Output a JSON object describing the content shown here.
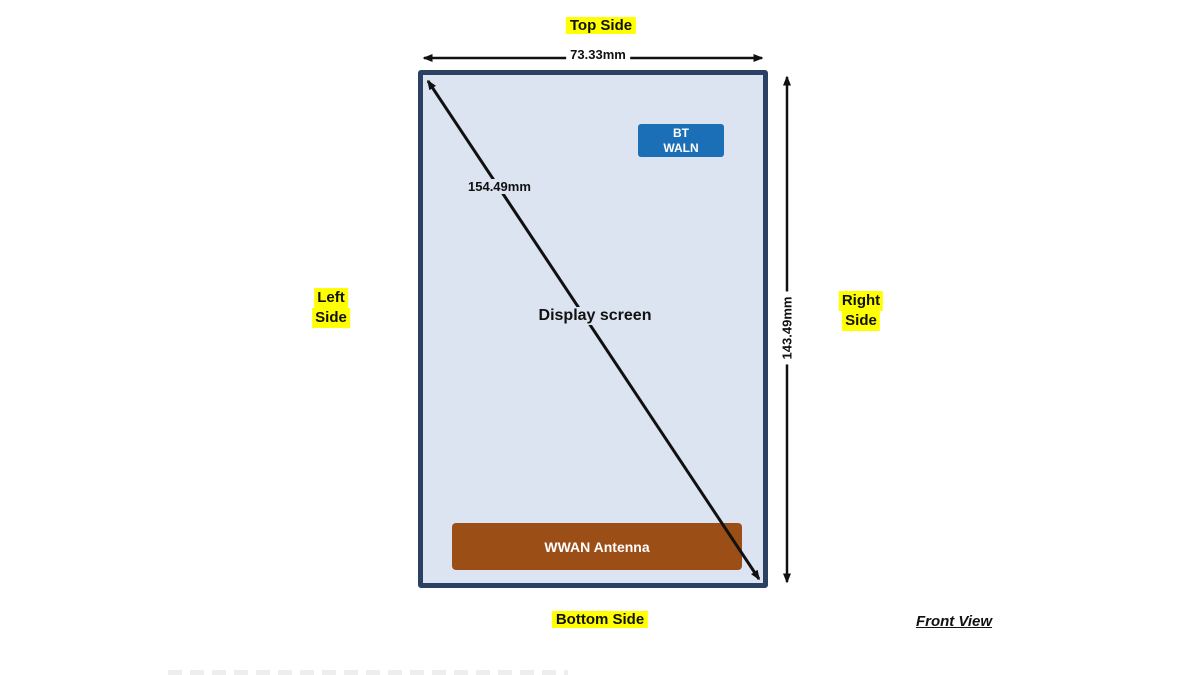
{
  "labels": {
    "top_side": "Top Side",
    "bottom_side": "Bottom Side",
    "left_side_line1": "Left",
    "left_side_line2": "Side",
    "right_side_line1": "Right",
    "right_side_line2": "Side",
    "front_view": "Front View"
  },
  "dimensions": {
    "width": "73.33mm",
    "height": "143.49mm",
    "diagonal": "154.49mm"
  },
  "device": {
    "screen_label": "Display screen",
    "badge_line1": "BT",
    "badge_line2": "WALN",
    "antenna_label": "WWAN Antenna"
  },
  "colors": {
    "highlight_yellow": "#ffff00",
    "screen_fill": "#dbe4f0",
    "device_border": "#2b4163",
    "badge_blue": "#1a6fb6",
    "antenna_brown": "#9c4e17",
    "arrow_black": "#111111",
    "background": "#ffffff"
  }
}
